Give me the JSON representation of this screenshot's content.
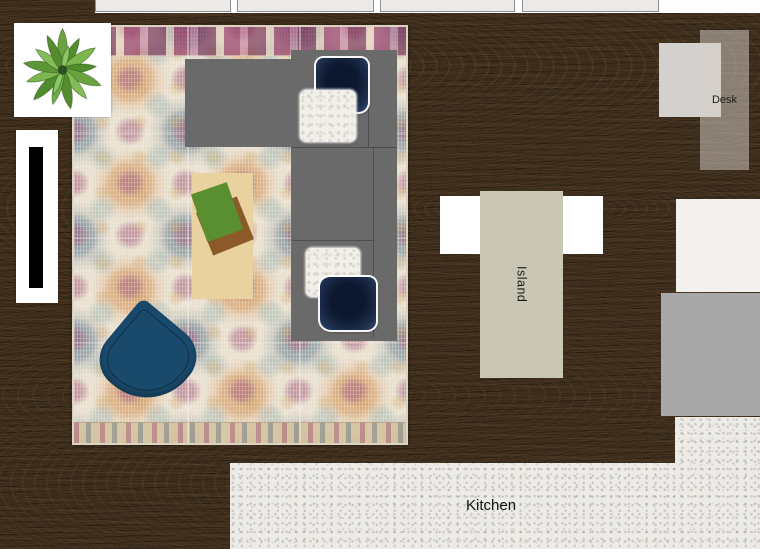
{
  "scene": {
    "type": "floor-plan",
    "description": "Living room and kitchen furniture layout plan"
  },
  "labels": {
    "desk": "Desk",
    "island": "Island",
    "kitchen": "Kitchen"
  },
  "colors": {
    "wood_floor": "#38291a",
    "rug_base": "#e9e0d0",
    "sofa": "#6a6a6a",
    "pillow_navy": "#13203a",
    "pillow_fur": "#f1efe9",
    "armchair": "#1a4a6b",
    "coffee_table": "#ead1a0",
    "book_green": "#5a8f31",
    "book_brown": "#8c5a28",
    "island": "#c9c6b3",
    "counter_white": "#ffffff",
    "kitchen_floor": "#edebe6",
    "desk_chair": "#d3d1ce",
    "side_rect_light": "#f2f1ee",
    "side_rect_gray": "#a8a8a8",
    "window": "#eceae8",
    "tv_black": "#000000"
  }
}
